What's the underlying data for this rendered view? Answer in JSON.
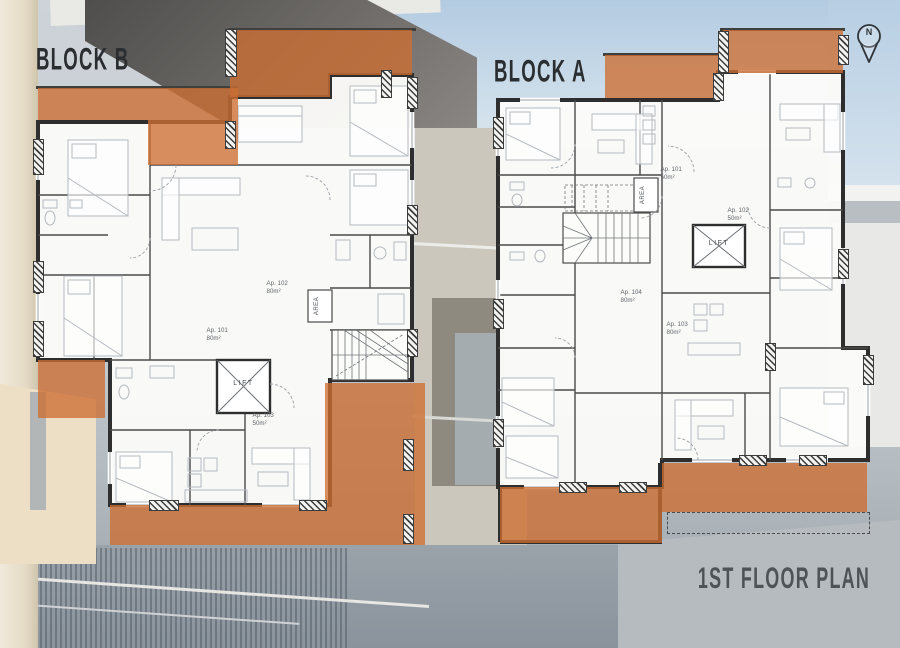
{
  "page_title": "1ST FLOOR PLAN",
  "north": {
    "label": "N"
  },
  "blocks": [
    {
      "name": "BLOCK B",
      "lift": "LIFT",
      "shaft": "AREA",
      "apartments": [
        {
          "id": "Ap. 101",
          "area": "80m²"
        },
        {
          "id": "Ap. 102",
          "area": "80m²"
        },
        {
          "id": "Ap. 103",
          "area": "50m²"
        }
      ]
    },
    {
      "name": "BLOCK A",
      "lift": "LIFT",
      "shaft": "AREA",
      "apartments": [
        {
          "id": "Ap. 101",
          "area": "50m²"
        },
        {
          "id": "Ap. 102",
          "area": "50m²"
        },
        {
          "id": "Ap. 103",
          "area": "80m²"
        },
        {
          "id": "Ap. 104",
          "area": "80m²"
        }
      ]
    }
  ],
  "colors": {
    "balcony_overlay": "#cd6e32",
    "wall": "#2e2e2e",
    "plan_fill": "#fbfbf9",
    "block_label_text": "#2b2e31",
    "title_text": "#4e5357"
  }
}
